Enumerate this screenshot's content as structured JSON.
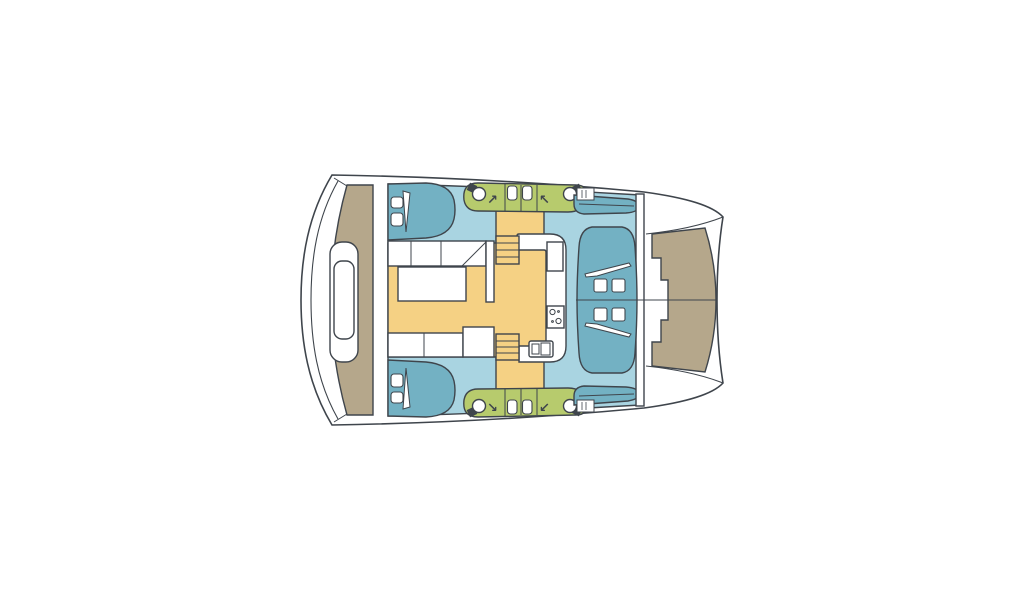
{
  "colors": {
    "background": "#ffffff",
    "outline": "#3f454c",
    "hull_white": "#ffffff",
    "deck_tan": "#b5a78b",
    "interior_blue": "#a9d4e1",
    "furniture_teal": "#73b1c3",
    "saloon_yellow": "#f5d184",
    "wet_area_green": "#b7cb6d"
  },
  "icons": {
    "arrow_ne": "↗",
    "arrow_nw": "↖",
    "arrow_se": "↘",
    "arrow_sw": "↙"
  }
}
